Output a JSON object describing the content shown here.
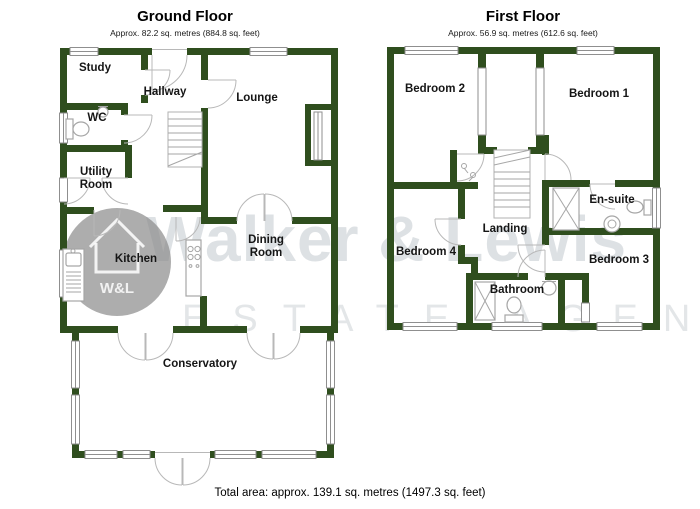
{
  "ground_floor": {
    "title": "Ground Floor",
    "subtitle": "Approx. 82.2 sq. metres (884.8 sq. feet)",
    "rooms": {
      "study": "Study",
      "hallway": "Hallway",
      "wc": "WC",
      "utility_line1": "Utility",
      "utility_line2": "Room",
      "lounge": "Lounge",
      "kitchen": "Kitchen",
      "dining_line1": "Dining",
      "dining_line2": "Room",
      "conservatory": "Conservatory"
    }
  },
  "first_floor": {
    "title": "First Floor",
    "subtitle": "Approx. 56.9 sq. metres (612.6 sq. feet)",
    "rooms": {
      "bedroom2": "Bedroom 2",
      "bedroom1": "Bedroom 1",
      "ensuite": "En-suite",
      "landing": "Landing",
      "bedroom4": "Bedroom 4",
      "bedroom3": "Bedroom 3",
      "bathroom": "Bathroom"
    }
  },
  "footer": {
    "total_area": "Total area: approx. 139.1 sq. metres (1497.3 sq. feet)"
  },
  "watermark": {
    "name": "Walker & Lewis",
    "tagline": "ESTATE AGENTS",
    "logo_text": "W&L"
  },
  "colors": {
    "wall_green": "#2f4e1e",
    "fixture_gray": "#a6a6a6",
    "watermark_gray": "#b6bdc4"
  }
}
